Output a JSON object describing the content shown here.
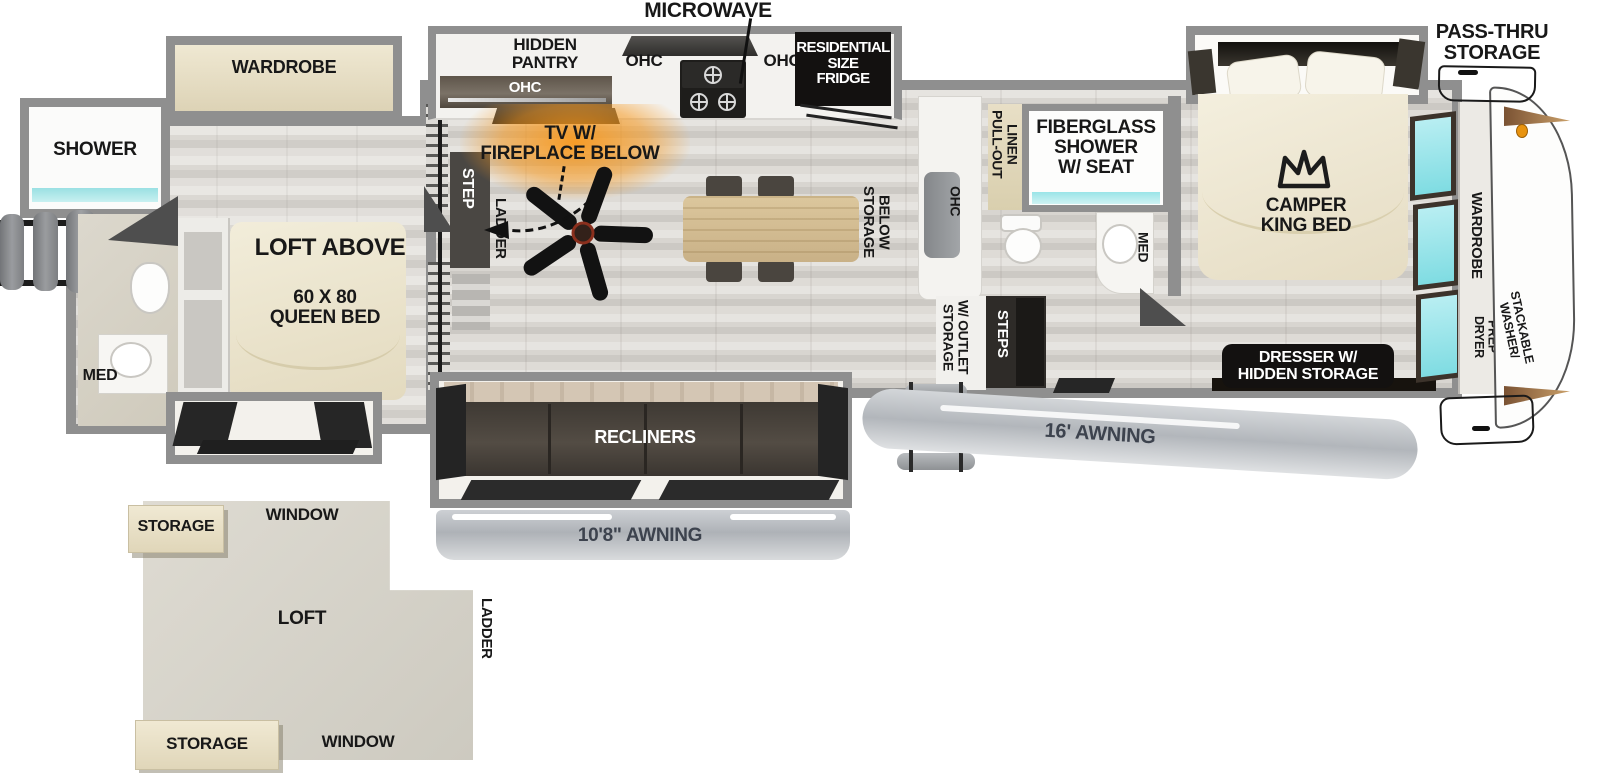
{
  "title": "Fifth Wheel RV Floorplan",
  "colors": {
    "wall_gray": "#8f8f8f",
    "window_teal": "#8fe2e8",
    "fireplace_glow": "#f7981d",
    "sofa_dark": "#453f39",
    "slide_beige": "#e9e1c8",
    "label_black_box": "#131110",
    "awning_text": "#3d434e",
    "cap_accent_brown": "#6b4a2c",
    "kingpin_orange": "#e8930f"
  },
  "labels": {
    "microwave": "MICROWAVE",
    "pass_thru": "PASS-THRU\nSTORAGE",
    "hidden_pantry": "HIDDEN\nPANTRY",
    "ohc_pantry": "OHC",
    "ohc_left": "OHC",
    "ohc_right": "OHC",
    "fridge": "RESIDENTIAL\nSIZE\nFRIDGE",
    "tv_fireplace": "TV W/\nFIREPLACE BELOW",
    "rear_wardrobe": "WARDROBE",
    "shower": "SHOWER",
    "loft_above": "LOFT ABOVE",
    "queen_bed": "60 X 80\nQUEEN BED",
    "rear_med": "MED",
    "step": "STEP",
    "rear_ladder": "LADDER",
    "storage_below": "STORAGE\nBELOW",
    "ohc_counter": "OHC",
    "storage_outlet": "STORAGE\nW/ OUTLET",
    "steps": "STEPS",
    "pull_out_linen": "PULL-OUT\nLINEN",
    "fiberglass_shower": "FIBERGLASS\nSHOWER\nW/ SEAT",
    "front_med": "MED",
    "camper_king": "CAMPER\nKING BED",
    "dresser": "DRESSER W/\nHIDDEN STORAGE",
    "front_wardrobe": "WARDROBE",
    "dryer_prep": "DRYER\nPREP",
    "stackable_washer": "STACKABLE\nWASHER/",
    "recliners": "RECLINERS",
    "awning_small": "10'8\" AWNING",
    "awning_large": "16' AWNING",
    "loft": "LOFT",
    "loft_window_top": "WINDOW",
    "loft_window_bottom": "WINDOW",
    "loft_storage_top": "STORAGE",
    "loft_storage_bottom": "STORAGE",
    "loft_ladder": "LADDER"
  }
}
